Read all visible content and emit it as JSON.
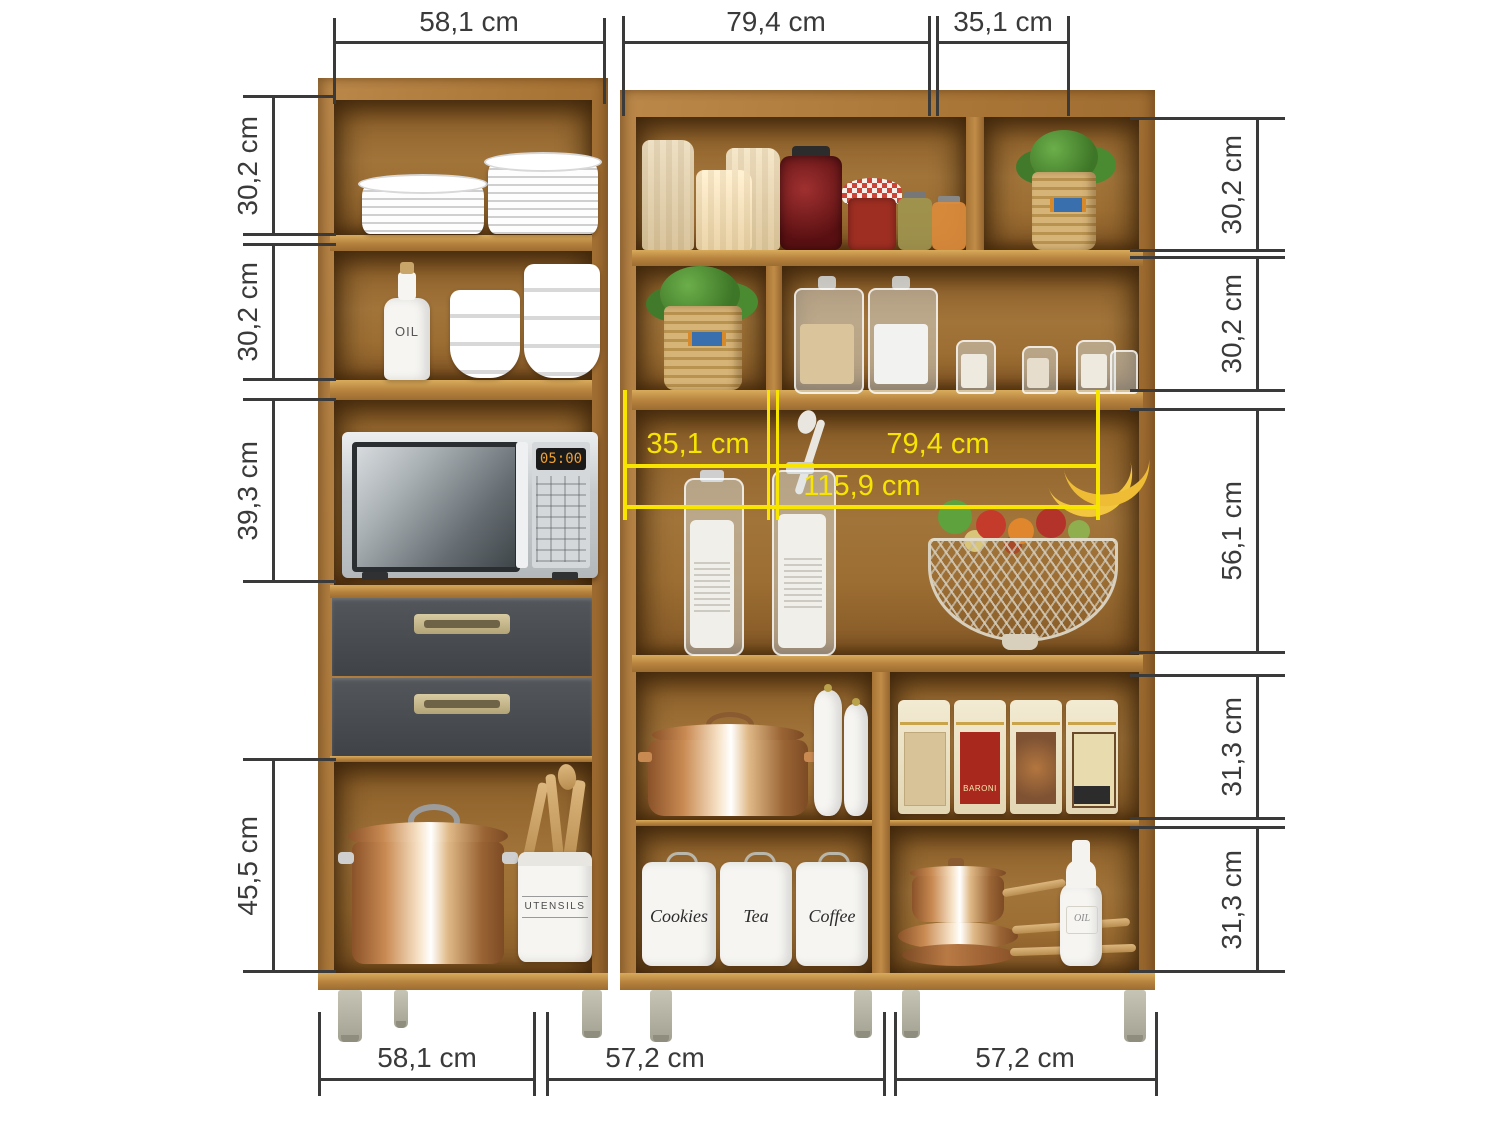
{
  "figure": {
    "type": "kitchen-cabinet-dimension-diagram",
    "unit": "cm"
  },
  "colors": {
    "dimension_line": "#3a3a3a",
    "inner_dimension_accent": "#f7e400",
    "wood": "#b5813d",
    "drawer": "#45494d",
    "background": "#ffffff"
  },
  "dimensions": {
    "top": [
      "58,1 cm",
      "79,4 cm",
      "35,1 cm"
    ],
    "bottom": [
      "58,1 cm",
      "57,2 cm",
      "57,2 cm"
    ],
    "left": [
      "30,2 cm",
      "30,2 cm",
      "39,3 cm",
      "45,5 cm"
    ],
    "right": [
      "30,2 cm",
      "30,2 cm",
      "56,1 cm",
      "31,3 cm",
      "31,3 cm"
    ],
    "inner": [
      "35,1 cm",
      "79,4 cm",
      "115,9 cm"
    ]
  },
  "labels": {
    "oil_bottle": "OIL",
    "utensil_crock": "UTENSILS",
    "microwave_display": "05:00",
    "canister_1": "Cookies",
    "canister_2": "Tea",
    "canister_3": "Coffee",
    "tin_red": "BARONI",
    "oil_bottle_small": "OIL"
  }
}
